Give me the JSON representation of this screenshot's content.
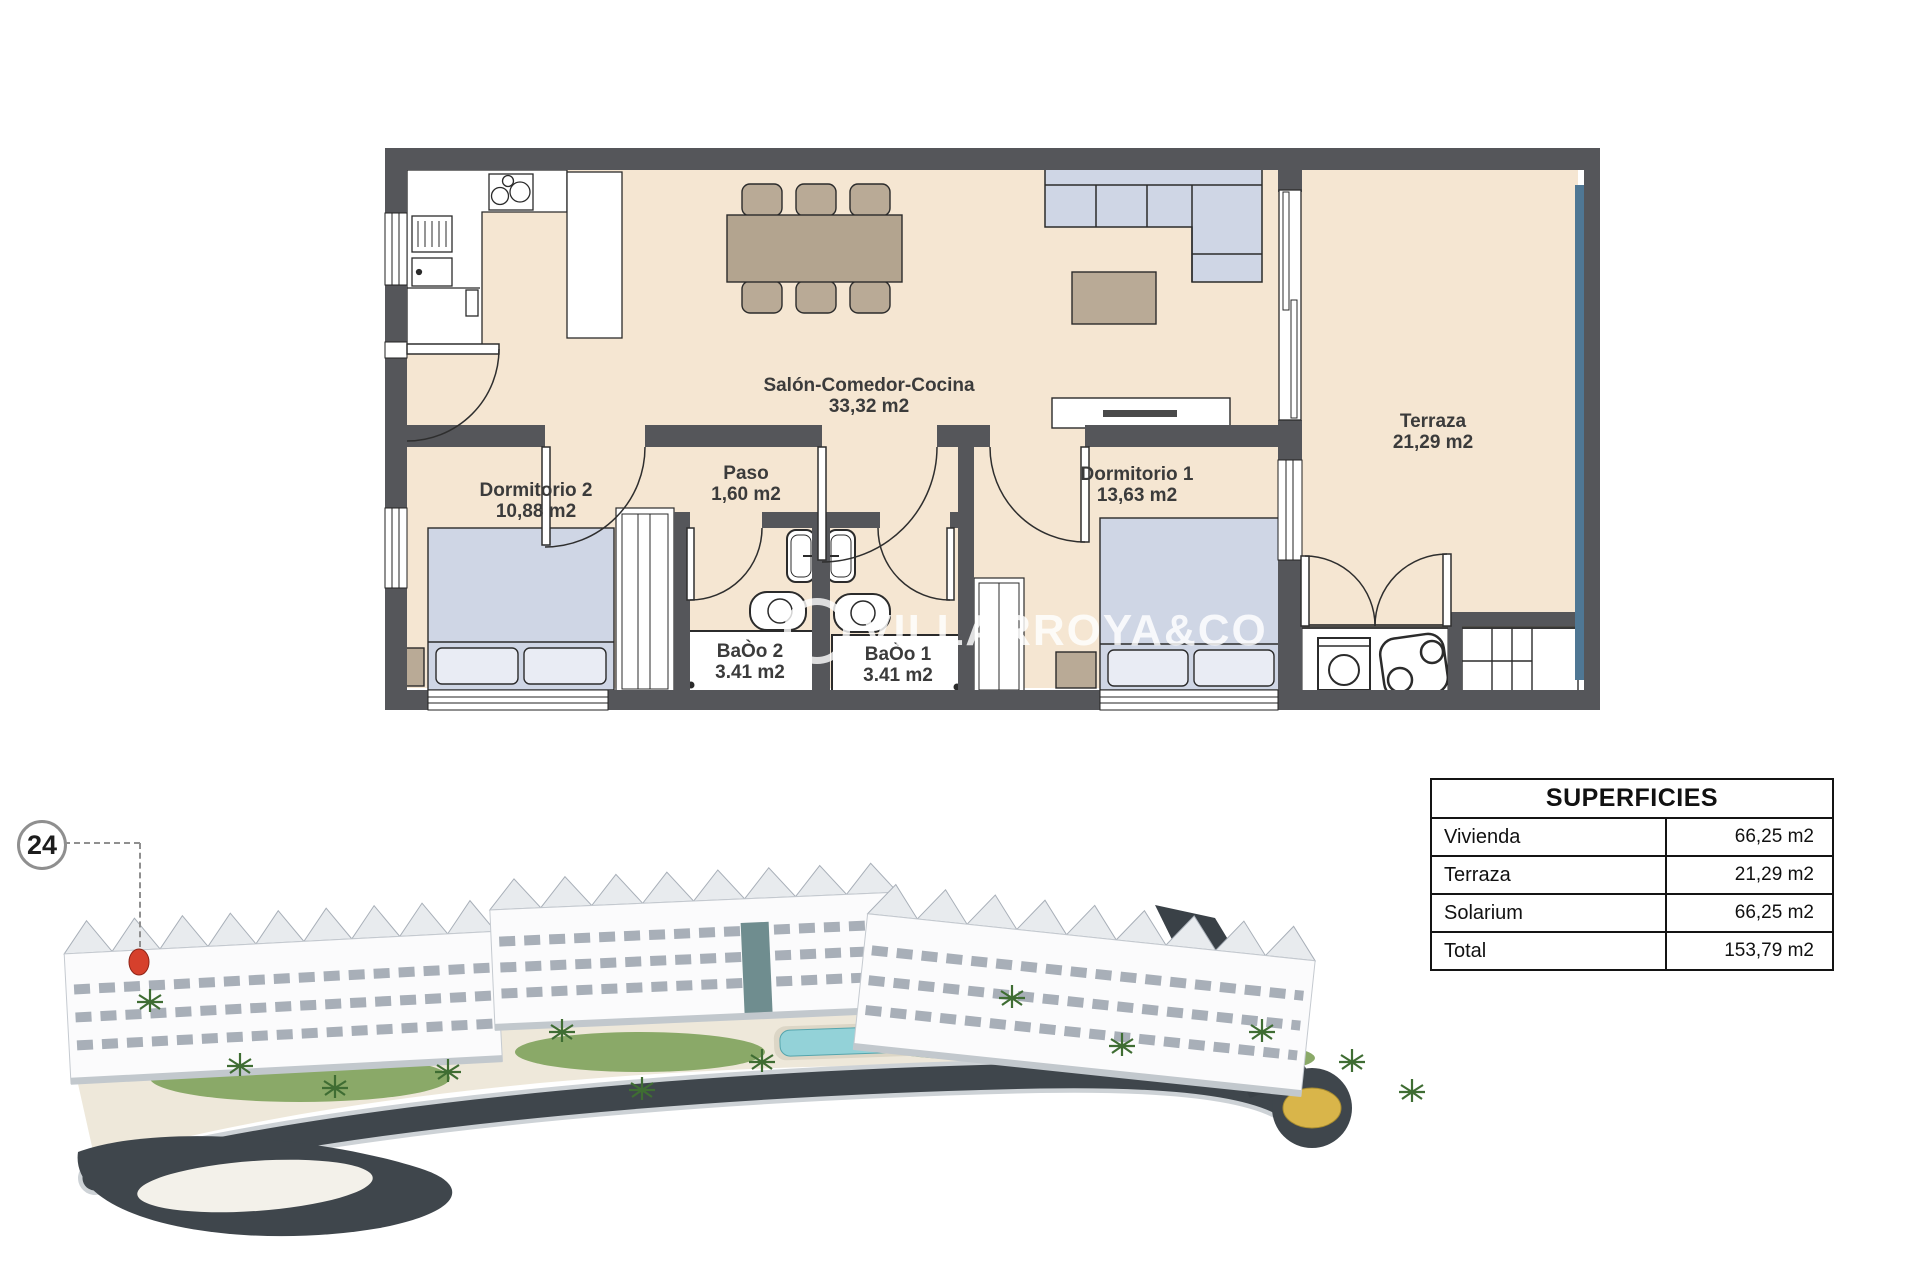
{
  "page": {
    "background": "#ffffff"
  },
  "floor_plan": {
    "watermark": "VILLARROYA&CO",
    "rooms": [
      {
        "name": "Salón-Comedor-Cocina",
        "area": "33,32 m2"
      },
      {
        "name": "Dormitorio 2",
        "area": "10,88 m2"
      },
      {
        "name": "Paso",
        "area": "1,60 m2"
      },
      {
        "name": "Dormitorio 1",
        "area": "13,63 m2"
      },
      {
        "name": "BaÒo 2",
        "area": "3.41 m2"
      },
      {
        "name": "BaÒo 1",
        "area": "3.41 m2"
      },
      {
        "name": "Terraza",
        "area": "21,29 m2"
      }
    ],
    "colors": {
      "wall": "#55565a",
      "floor": "#f5e6d2",
      "furniture_tan": "#b9aa96",
      "soft_blue": "#cfd6e5",
      "glass_blue": "#4f7794"
    }
  },
  "site_plan": {
    "unit_marker": "24",
    "marker_color": "#d6402c",
    "road_color": "#3f464c",
    "roundabout_color": "#d9b54a",
    "pool_color": "#93d2d8"
  },
  "superficies_table": {
    "title": "SUPERFICIES",
    "rows": [
      {
        "label": "Vivienda",
        "value": "66,25 m2"
      },
      {
        "label": "Terraza",
        "value": "21,29 m2"
      },
      {
        "label": "Solarium",
        "value": "66,25 m2"
      },
      {
        "label": "Total",
        "value": "153,79 m2"
      }
    ]
  }
}
